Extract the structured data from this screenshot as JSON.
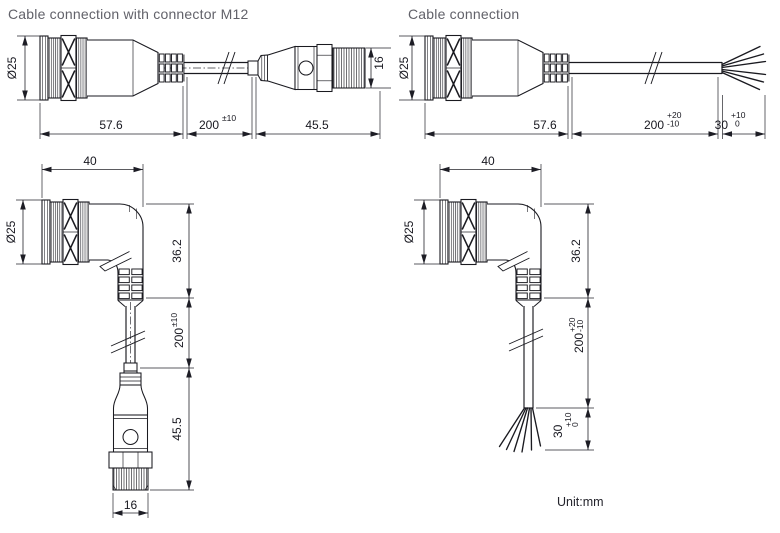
{
  "titles": {
    "straight_m12": "Cable connection with connector M12",
    "straight_wire": "Cable connection"
  },
  "unit_note": "Unit:mm",
  "dimensions": {
    "straight_m12": {
      "diameter": "Ø25",
      "body_length": "57.6",
      "cable_length": "200",
      "cable_tolerance": "±10",
      "plug_length": "45.5",
      "plug_diameter": "16"
    },
    "straight_wire": {
      "diameter": "Ø25",
      "body_length": "57.6",
      "cable_length": "200",
      "cable_tol_upper": "+20",
      "cable_tol_lower": "-10",
      "strip_length": "30",
      "strip_tol_upper": "+10",
      "strip_tol_lower": "0"
    },
    "angled_m12": {
      "body_width": "40",
      "diameter": "Ø25",
      "body_height": "36.2",
      "cable_length": "200",
      "cable_tolerance": "±10",
      "plug_length": "45.5",
      "plug_diameter": "16"
    },
    "angled_wire": {
      "body_width": "40",
      "diameter": "Ø25",
      "body_height": "36.2",
      "cable_length": "200",
      "cable_tol_upper": "+20",
      "cable_tol_lower": "-10",
      "strip_length": "30",
      "strip_tol_upper": "+10",
      "strip_tol_lower": "0"
    }
  }
}
